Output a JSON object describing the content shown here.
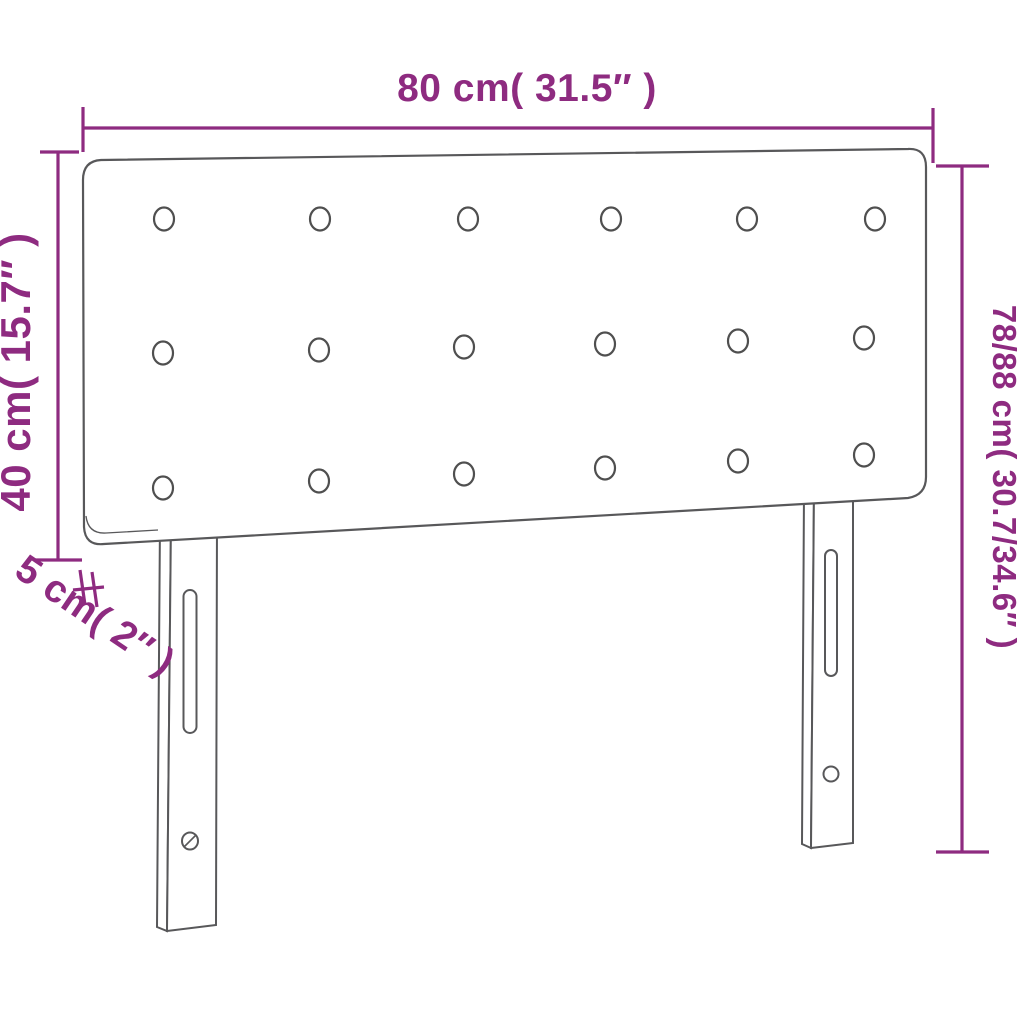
{
  "diagram": {
    "type": "product-dimension-diagram",
    "product": "tufted headboard with two legs",
    "labels": {
      "width_top": "80 cm( 31.5″ )",
      "height_left": "40 cm( 15.7″ )",
      "height_right": "78/88 cm( 30.7/34.6″ )",
      "thickness_bottom_left": "5 cm( 2″ )"
    },
    "tufting_buttons": {
      "rows": 3,
      "columns": 6,
      "total": 18
    },
    "legs": 2,
    "colors": {
      "dimension_annotation": "#8e2b80",
      "product_outline": "#58585a",
      "background": "#ffffff"
    }
  }
}
